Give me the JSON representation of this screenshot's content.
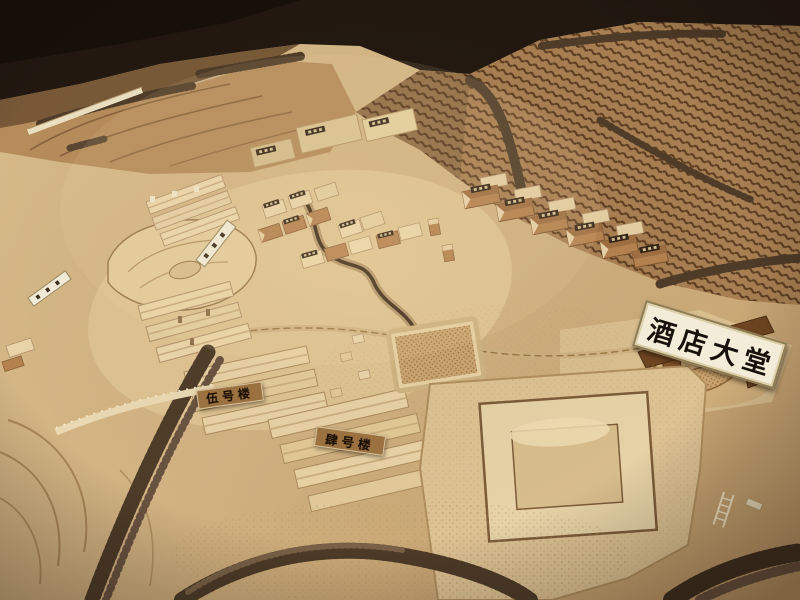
{
  "scene": {
    "description": "Photograph of a laser-cut wooden architectural scale model of a hillside resort village with terraced slopes, tree rows, building clusters and labelled signs"
  },
  "signs": {
    "hotel_lobby": {
      "text": "酒店大堂"
    },
    "building_no5": {
      "text": "伍号楼"
    },
    "building_no4": {
      "text": "肆号楼"
    }
  },
  "colors": {
    "backdrop_dark": "#221810",
    "furniture_dark": "#171009",
    "floor_wood": "#6e4e2f",
    "terrain_light": "#d8bb8a",
    "terrain_deep": "#c09a68",
    "terrace_base": "#a87f52",
    "terrace_line": "#5e3d20",
    "model_wood": "#ead5a8",
    "cork_brown": "#b5824f",
    "plaque_dark": "#352516",
    "plaque_text": "#d6c193",
    "sign_bg": "#f3ecd9",
    "sign_text": "#17120c",
    "plaque_wood_bg": "#9c7140",
    "tree": "#4e3b28",
    "stream": "#3f2c1a",
    "lake_fill": "#e6cc9b",
    "pad_wood": "#ddc293"
  }
}
